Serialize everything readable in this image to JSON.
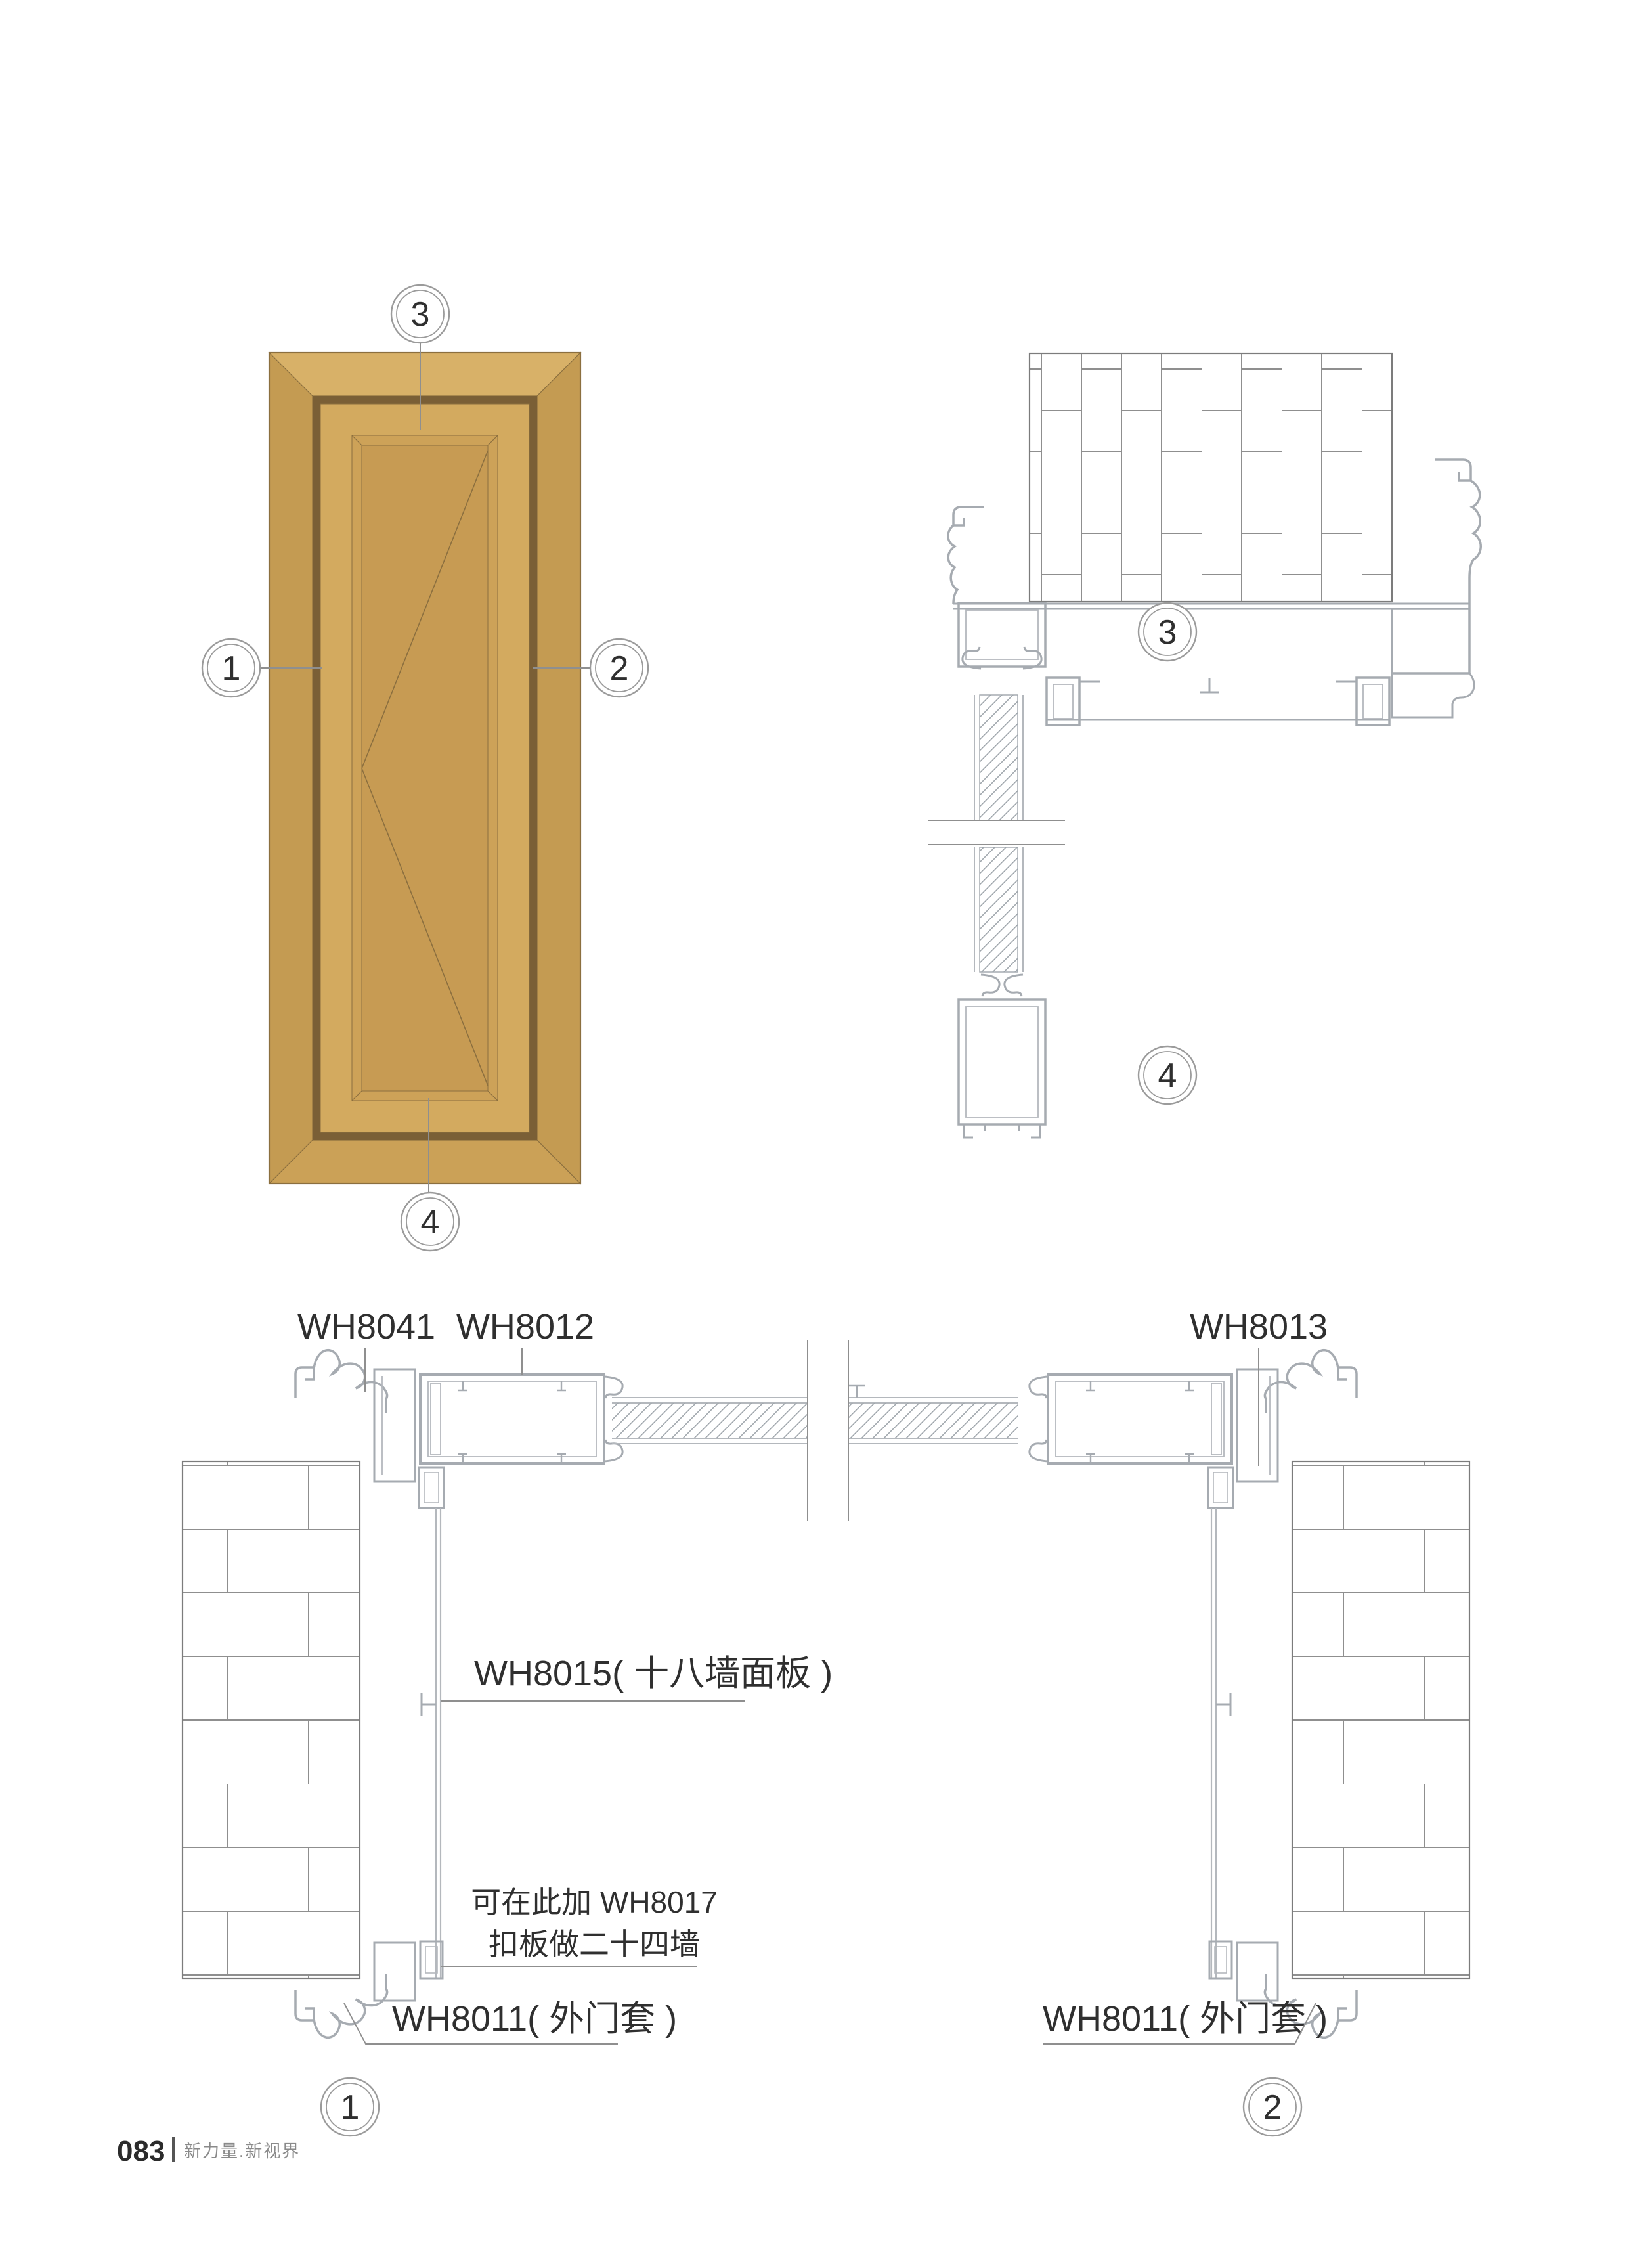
{
  "footer": {
    "page_number": "083",
    "slogan": "新力量.新视界"
  },
  "elevation": {
    "balloon_top": "3",
    "balloon_left": "1",
    "balloon_right": "2",
    "balloon_bottom": "4"
  },
  "section": {
    "balloon_head": "3",
    "balloon_sill": "4"
  },
  "plan": {
    "label_wh8041": "WH8041",
    "label_wh8012": "WH8012",
    "label_wh8013": "WH8013",
    "label_wh8015": "WH8015( 十八墙面板 )",
    "note_line1": "可在此加 WH8017",
    "note_line2": "扣板做二十四墙",
    "label_wh8011_left": "WH8011( 外门套 )",
    "label_wh8011_right": "WH8011( 外门套 )",
    "balloon_left": "1",
    "balloon_right": "2"
  },
  "colors": {
    "door_frame_top": "#D8B168",
    "door_frame_side": "#C49B52",
    "door_frame_bottom": "#CBA157",
    "door_reveal_dark": "#7A5F36",
    "door_leaf": "#D3AA5F",
    "door_bevel": "#CDA258",
    "door_panel": "#C79B53",
    "line_brown": "#8B6F3F",
    "cad_line": "#A6ABB1",
    "brick_line": "#8F8F8F"
  }
}
